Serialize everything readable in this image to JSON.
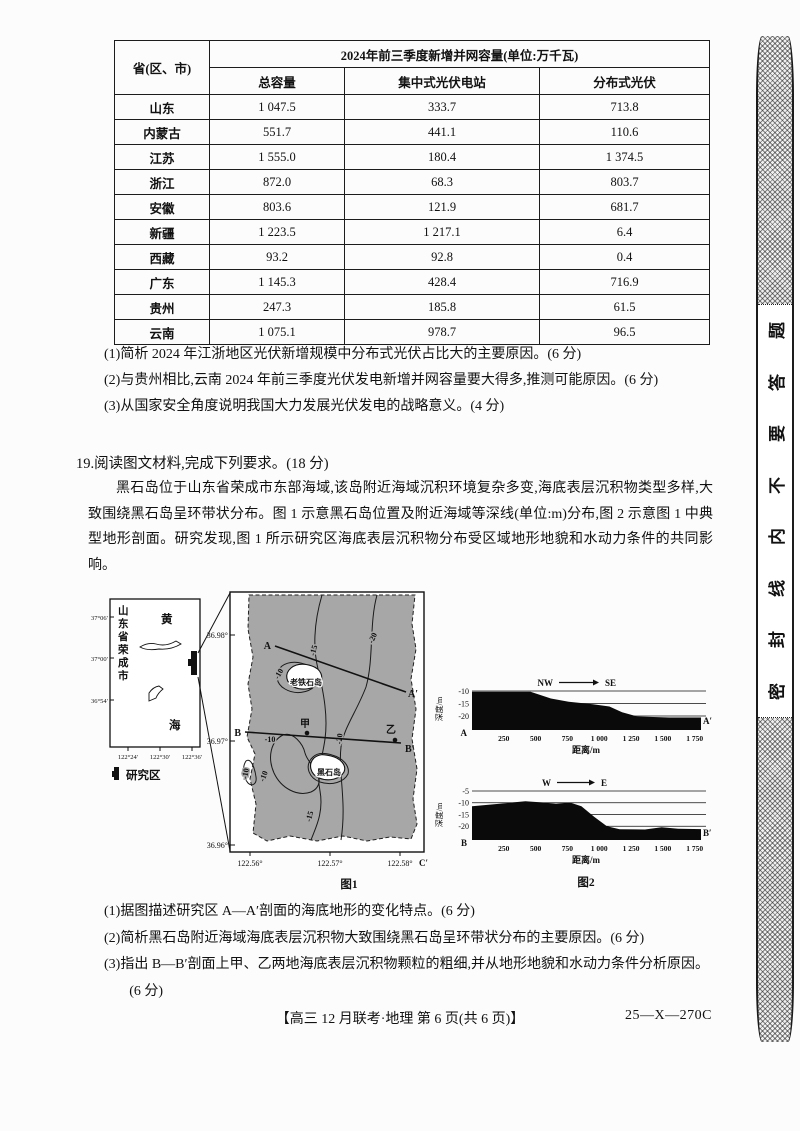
{
  "table": {
    "col0": "省(区、市)",
    "span": "2024年前三季度新增并网容量(单位:万千瓦)",
    "sub": [
      "总容量",
      "集中式光伏电站",
      "分布式光伏"
    ],
    "rows": [
      [
        "山东",
        "1 047.5",
        "333.7",
        "713.8"
      ],
      [
        "内蒙古",
        "551.7",
        "441.1",
        "110.6"
      ],
      [
        "江苏",
        "1 555.0",
        "180.4",
        "1 374.5"
      ],
      [
        "浙江",
        "872.0",
        "68.3",
        "803.7"
      ],
      [
        "安徽",
        "803.6",
        "121.9",
        "681.7"
      ],
      [
        "新疆",
        "1 223.5",
        "1 217.1",
        "6.4"
      ],
      [
        "西藏",
        "93.2",
        "92.8",
        "0.4"
      ],
      [
        "广东",
        "1 145.3",
        "428.4",
        "716.9"
      ],
      [
        "贵州",
        "247.3",
        "185.8",
        "61.5"
      ],
      [
        "云南",
        "1 075.1",
        "978.7",
        "96.5"
      ]
    ]
  },
  "q18": {
    "items": [
      "(1)简析 2024 年江浙地区光伏新增规模中分布式光伏占比大的主要原因。(6 分)",
      "(2)与贵州相比,云南 2024 年前三季度光伏发电新增并网容量要大得多,推测可能原因。(6 分)",
      "(3)从国家安全角度说明我国大力发展光伏发电的战略意义。(4 分)"
    ]
  },
  "q19": {
    "heading": "19.阅读图文材料,完成下列要求。(18 分)",
    "paragraph": "黑石岛位于山东省荣成市东部海域,该岛附近海域沉积环境复杂多变,海底表层沉积物类型多样,大致围绕黑石岛呈环带状分布。图 1 示意黑石岛位置及附近海域等深线(单位:m)分布,图 2 示意图 1 中典型地形剖面。研究发现,图 1 所示研究区海底表层沉积物分布受区域地形地貌和水动力条件的共同影响。",
    "items": [
      "(1)据图描述研究区 A—A′剖面的海底地形的变化特点。(6 分)",
      "(2)简析黑石岛附近海域海底表层沉积物大致围绕黑石岛呈环带状分布的主要原因。(6 分)",
      "(3)指出 B—B′剖面上甲、乙两地海底表层沉积物颗粒的粗细,并从地形地貌和水动力条件分析原因。(6 分)"
    ]
  },
  "fig1": {
    "caption": "图1",
    "inset": {
      "lat": [
        "37°06′",
        "37°00′",
        "36°54′"
      ],
      "lon": [
        "122°24′",
        "122°30′",
        "122°36′"
      ],
      "region_chars": [
        "山",
        "东",
        "省",
        "荣",
        "成",
        "市"
      ],
      "sea_char_top": "黄",
      "sea_char_bottom": "海",
      "legend": "研究区"
    },
    "main": {
      "lat": [
        "36.98°",
        "36.97°",
        "36.96°"
      ],
      "lon": [
        "122.56°",
        "122.57°",
        "122.58°"
      ],
      "corner": "C′",
      "island_upper": "老铁石岛",
      "island_lower": "黑石岛",
      "a_start": "A",
      "a_end": "A′",
      "b_start": "B",
      "b_end": "B′",
      "pt_jia": "甲",
      "pt_yi": "乙",
      "contours": {
        "c10": "-10",
        "c15": "-15",
        "c20": "-20",
        "c0": "0"
      }
    }
  },
  "fig2": {
    "caption": "图2",
    "ylabel": "深度/m",
    "xlabel": "距离/m",
    "p0": {
      "from": "NW",
      "to": "SE",
      "start": "A",
      "end": "A′"
    },
    "p1": {
      "from": "W",
      "to": "E",
      "start": "B",
      "end": "B′"
    }
  },
  "chart_data": [
    {
      "type": "area",
      "title": "A—A′剖面海底地形",
      "direction": "NW→SE",
      "xlabel": "距离/m",
      "ylabel": "深度/m",
      "xlim": [
        0,
        1800
      ],
      "xticks": [
        250,
        500,
        750,
        1000,
        1250,
        1500,
        1750
      ],
      "yticks": [
        -10,
        -15,
        -20
      ],
      "points": [
        [
          0,
          -10.3
        ],
        [
          460,
          -10.3
        ],
        [
          620,
          -13
        ],
        [
          760,
          -14.3
        ],
        [
          950,
          -15.3
        ],
        [
          1080,
          -16.2
        ],
        [
          1180,
          -18.5
        ],
        [
          1300,
          -20.2
        ],
        [
          1550,
          -20.6
        ],
        [
          1800,
          -20.6
        ]
      ]
    },
    {
      "type": "area",
      "title": "B—B′剖面海底地形",
      "direction": "W→E",
      "xlabel": "距离/m",
      "ylabel": "深度/m",
      "xlim": [
        0,
        1800
      ],
      "xticks": [
        250,
        500,
        750,
        1000,
        1250,
        1500,
        1750
      ],
      "yticks": [
        -5,
        -10,
        -15,
        -20
      ],
      "points": [
        [
          0,
          -11.5
        ],
        [
          260,
          -10.2
        ],
        [
          420,
          -9.4
        ],
        [
          560,
          -9.9
        ],
        [
          660,
          -10.4
        ],
        [
          770,
          -9.9
        ],
        [
          860,
          -11.5
        ],
        [
          960,
          -16
        ],
        [
          1060,
          -20
        ],
        [
          1160,
          -21.3
        ],
        [
          1360,
          -21.4
        ],
        [
          1490,
          -20.4
        ],
        [
          1620,
          -21.1
        ],
        [
          1800,
          -21.2
        ]
      ]
    }
  ],
  "seal": {
    "chars": [
      "题",
      "答",
      "要",
      "不",
      "内",
      "线",
      "封",
      "密"
    ]
  },
  "footer": {
    "center": "【高三 12 月联考·地理  第 6 页(共 6 页)】",
    "code": "25—X—270C"
  }
}
